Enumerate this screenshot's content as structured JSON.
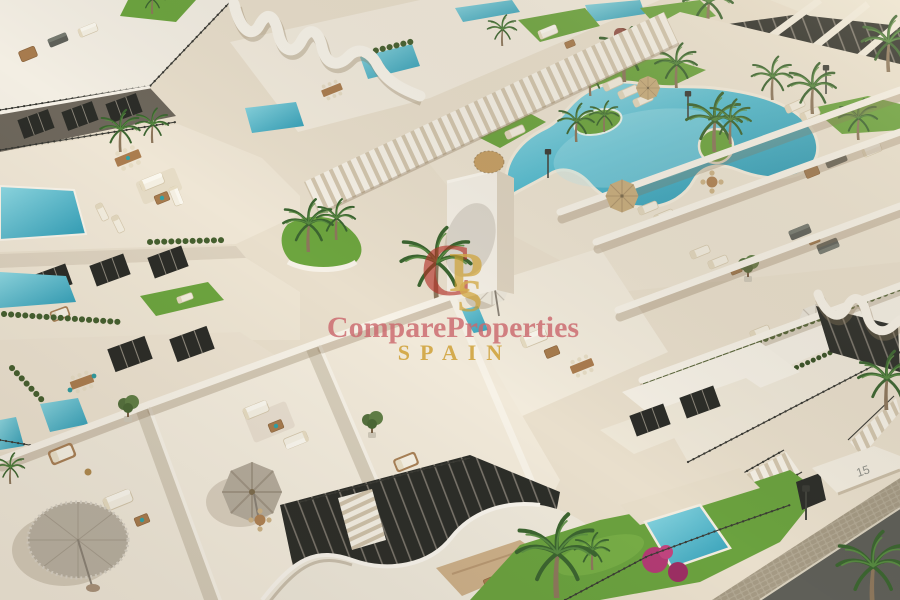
{
  "meta": {
    "description": "Aerial 3D architectural render of a modern white apartment complex with a freeform community pool, private plunge pools, roof terraces with outdoor furniture, palm trees and a street corner",
    "kind": "photo-render"
  },
  "watermark": {
    "brand": "CompareProperties",
    "country": "SPAIN",
    "logo": {
      "c": "C",
      "p": "P",
      "s": "S"
    },
    "colors": {
      "brand_rose": "#cb686c",
      "gold": "#cfa23a",
      "logo_red": "#b23128"
    }
  },
  "signage": {
    "house_number": "15"
  },
  "palette": {
    "wall_white": "#f4efe5",
    "wall_shade": "#d9cdb8",
    "deck": "#ece3d1",
    "pool_light": "#9fe0ea",
    "pool_deep": "#2a93ad",
    "lawn": "#6da53f",
    "hedge": "#46602f",
    "palm_frond": "#3c6530",
    "wood": "#a87c4e",
    "street": "#5f5f58",
    "railing": "#3b3b35"
  }
}
